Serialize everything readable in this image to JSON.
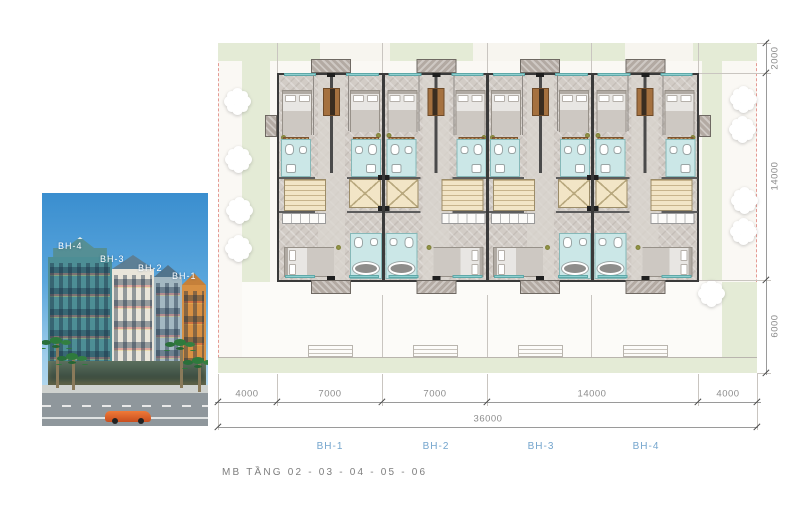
{
  "caption": "MB TẦNG 02 - 03 - 04 - 05 - 06",
  "photo": {
    "labels": [
      "BH-4",
      "BH-3",
      "BH-2",
      "BH-1"
    ]
  },
  "plan": {
    "dims_bottom": [
      "4000",
      "7000",
      "7000",
      "14000",
      "4000"
    ],
    "dim_total": "36000",
    "dims_right": [
      "2000",
      "14000",
      "6000"
    ],
    "unit_labels": [
      "BH-1",
      "BH-2",
      "BH-3",
      "BH-4"
    ]
  },
  "colors": {
    "accent_blue": "#74a5cd",
    "boundary_dash": "#e59a93",
    "site_green": "#e4ebd6"
  }
}
